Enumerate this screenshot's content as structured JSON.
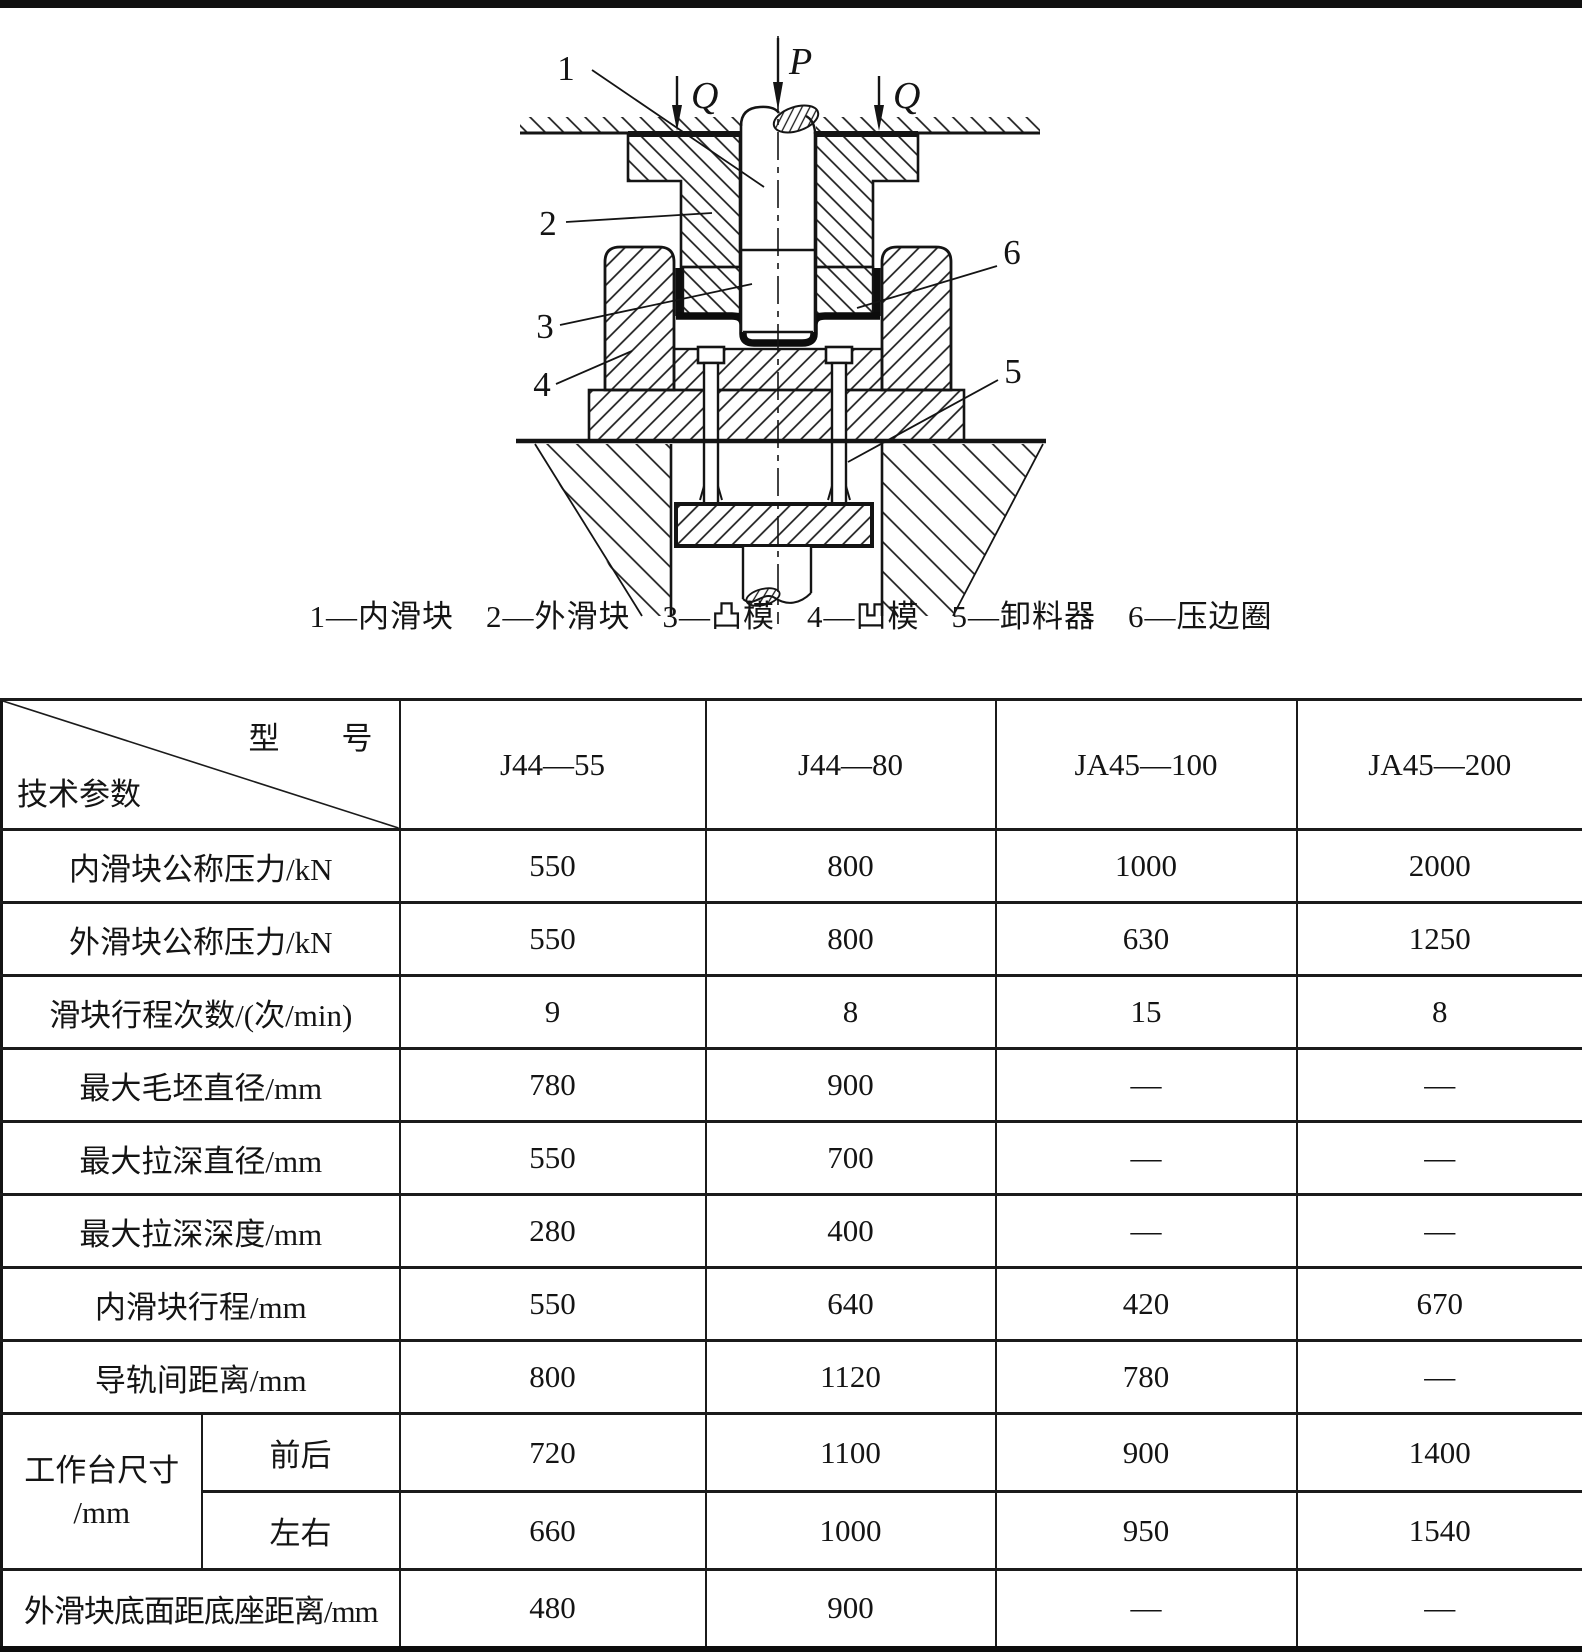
{
  "figure": {
    "force_labels": {
      "p": "P",
      "q_left": "Q",
      "q_right": "Q"
    },
    "part_numbers": {
      "n1": "1",
      "n2": "2",
      "n3": "3",
      "n4": "4",
      "n5": "5",
      "n6": "6"
    },
    "caption": "1—内滑块　2—外滑块　3—凸模　4—凹模　5—卸料器　6—压边圈"
  },
  "table": {
    "header": {
      "diagonal_top": "型　　号",
      "diagonal_bottom": "技术参数",
      "models": [
        "J44—55",
        "J44—80",
        "JA45—100",
        "JA45—200"
      ]
    },
    "rows": [
      {
        "label": "内滑块公称压力/kN",
        "values": [
          "550",
          "800",
          "1000",
          "2000"
        ]
      },
      {
        "label": "外滑块公称压力/kN",
        "values": [
          "550",
          "800",
          "630",
          "1250"
        ]
      },
      {
        "label": "滑块行程次数/(次/min)",
        "values": [
          "9",
          "8",
          "15",
          "8"
        ]
      },
      {
        "label": "最大毛坯直径/mm",
        "values": [
          "780",
          "900",
          "—",
          "—"
        ]
      },
      {
        "label": "最大拉深直径/mm",
        "values": [
          "550",
          "700",
          "—",
          "—"
        ]
      },
      {
        "label": "最大拉深深度/mm",
        "values": [
          "280",
          "400",
          "—",
          "—"
        ]
      },
      {
        "label": "内滑块行程/mm",
        "values": [
          "550",
          "640",
          "420",
          "670"
        ]
      },
      {
        "label": "导轨间距离/mm",
        "values": [
          "800",
          "1120",
          "780",
          "—"
        ]
      }
    ],
    "worktable": {
      "label_line1": "工作台尺寸",
      "label_line2": "/mm",
      "front_back": {
        "label": "前后",
        "values": [
          "720",
          "1100",
          "900",
          "1400"
        ]
      },
      "left_right": {
        "label": "左右",
        "values": [
          "660",
          "1000",
          "950",
          "1540"
        ]
      }
    },
    "bottom_row": {
      "label": "外滑块底面距底座距离/mm",
      "values": [
        "480",
        "900",
        "—",
        "—"
      ]
    }
  }
}
